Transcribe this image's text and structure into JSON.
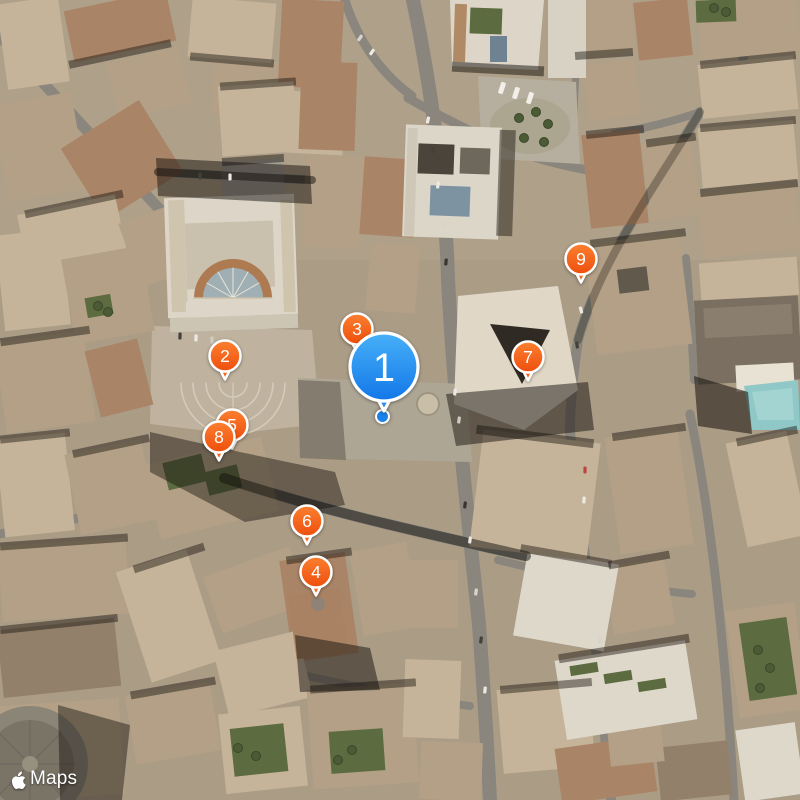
{
  "attribution": {
    "label": "Maps"
  },
  "map": {
    "view": "satellite",
    "markers": [
      {
        "label": "1",
        "style": "primary",
        "x": 384,
        "y": 367,
        "z": 20
      },
      {
        "label": "2",
        "style": "pin",
        "x": 225,
        "y": 356,
        "z": 10
      },
      {
        "label": "3",
        "style": "pin",
        "x": 357,
        "y": 329,
        "z": 9
      },
      {
        "label": "4",
        "style": "pin",
        "x": 316,
        "y": 572,
        "z": 10
      },
      {
        "label": "5",
        "style": "pin",
        "x": 232,
        "y": 425,
        "z": 8
      },
      {
        "label": "6",
        "style": "pin",
        "x": 307,
        "y": 521,
        "z": 10
      },
      {
        "label": "7",
        "style": "pin",
        "x": 528,
        "y": 357,
        "z": 10
      },
      {
        "label": "8",
        "style": "pin",
        "x": 219,
        "y": 437,
        "z": 10
      },
      {
        "label": "9",
        "style": "pin",
        "x": 581,
        "y": 259,
        "z": 10
      }
    ],
    "user_location_dot": {
      "x": 383,
      "y": 417
    },
    "colors": {
      "pin_orange_top": "#fb8030",
      "pin_orange_bottom": "#ee4e0c",
      "pin_blue_top": "#47b0f8",
      "pin_blue_bottom": "#1277e8",
      "pin_ring": "#ffffff",
      "location_dot": "#1b80e8"
    }
  }
}
